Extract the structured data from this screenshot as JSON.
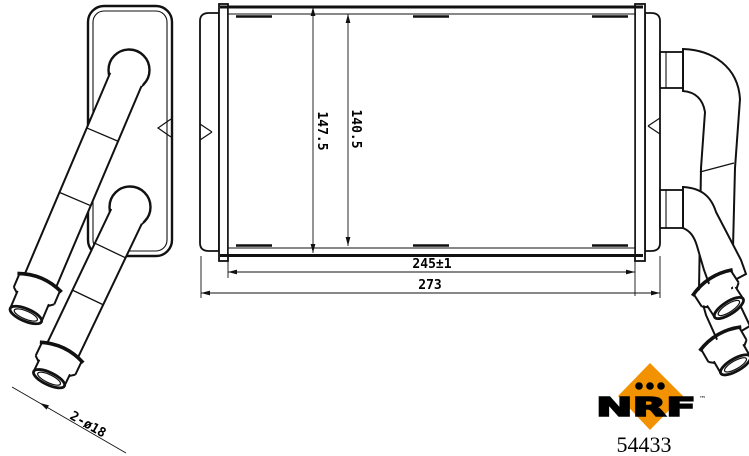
{
  "dimensions": {
    "overall_height": "147.5",
    "core_height": "140.5",
    "core_width": "245±1",
    "overall_width": "273",
    "pipes_label": "2-ø18"
  },
  "logo": {
    "brand": "NRF",
    "trademark": "™",
    "part_number": "54433",
    "orange": "#F29200",
    "line_color": "#111111"
  }
}
